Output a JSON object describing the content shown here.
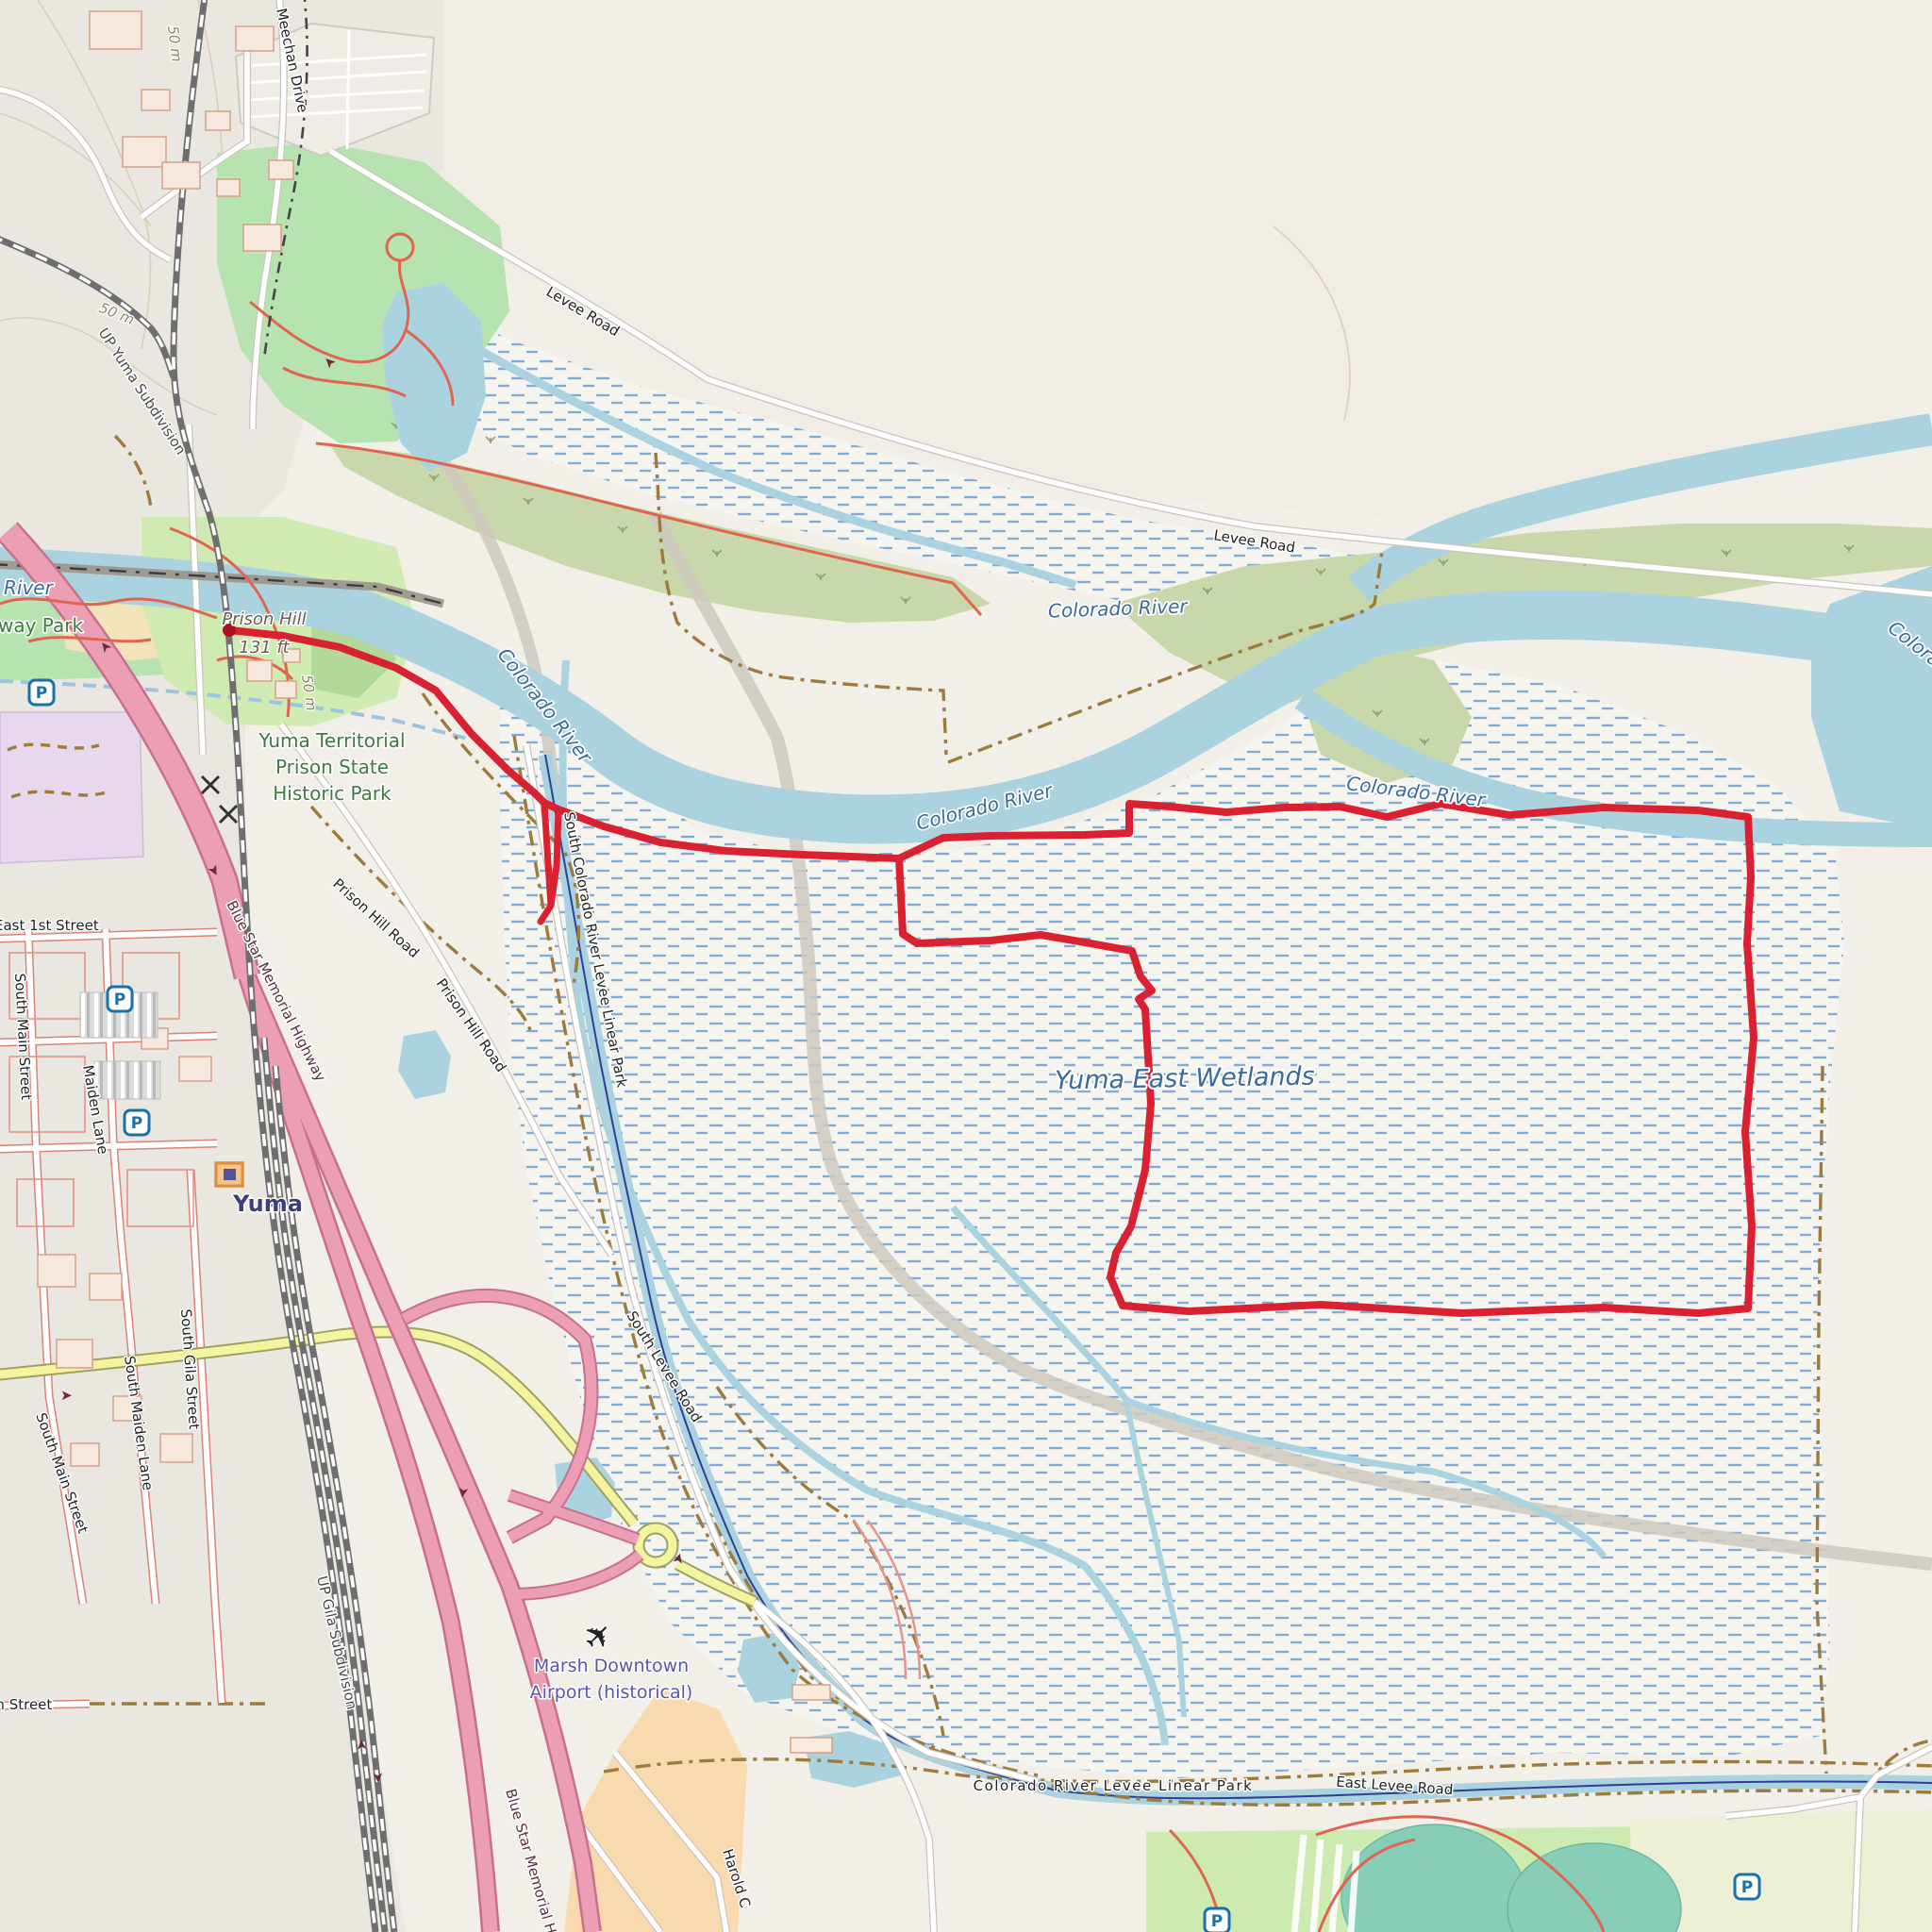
{
  "labels": {
    "meechan_drive": "Meechan Drive",
    "contour_50m": "50 m",
    "up_yuma_subdivision": "UP Yuma Subdivision",
    "up_gila_subdivision": "UP Gila Subdivision",
    "levee_road": "Levee Road",
    "east_levee_road": "East Levee Road",
    "colorado_river": "Colorado River",
    "colorado_river_levee_linear_park": "Colorado River Levee Linear Park",
    "south_colorado_river_levee_linear_park": "South Colorado River Levee Linear Park",
    "south_levee_road": "South Levee Road",
    "yuma_east_wetlands": "Yuma East Wetlands",
    "prison_hill": "Prison Hill",
    "prison_hill_elevation": "131 ft",
    "prison_park_line1": "Yuma Territorial",
    "prison_park_line2": "Prison State",
    "prison_park_line3": "Historic Park",
    "river_partial": "River",
    "way_park_partial": "way Park",
    "blue_star_memorial_highway": "Blue Star Memorial Highway",
    "prison_hill_road": "Prison Hill Road",
    "east_1st_street": "East 1st Street",
    "south_main_street": "South Main Street",
    "maiden_lane": "Maiden Lane",
    "south_maiden_lane": "South Maiden Lane",
    "south_gila_street": "South Gila Street",
    "fifth_street": "5th Street",
    "yuma_city": "Yuma",
    "marsh_airport_line1": "Marsh Downtown",
    "marsh_airport_line2": "Airport (historical)",
    "harold_street": "Harold C"
  },
  "icons": {
    "parking": "P",
    "plane": "✈"
  },
  "route": {
    "color": "#da2131",
    "start_label": "Prison Hill"
  },
  "colors": {
    "background": "#f2efe9",
    "water": "#aad3df",
    "water_label": "#3a6b99",
    "wetland_dash": "#82abd8",
    "park_green": "#b7e3b0",
    "grass_green": "#cdebb0",
    "scrub_olive": "#c9d8ab",
    "farmland": "#eef0d5",
    "pond_teal": "#86ceb8",
    "sand": "#f2e3ba",
    "apron_peach": "#f9d9ae",
    "retail_purple": "#e7d8ee",
    "highway_pink": "#ec9fb4",
    "highway_casing": "#c96f8d",
    "road_yellow": "#f3f3a0",
    "road_casing": "#c9c5bd",
    "old_road_gray": "#cfc9be",
    "railway_gray": "#6e6e6e",
    "route_red": "#da2131",
    "trail_brown": "#9c7b3c",
    "canal_navy": "#2e3e9a",
    "parking_blue": "#1a6fad"
  }
}
